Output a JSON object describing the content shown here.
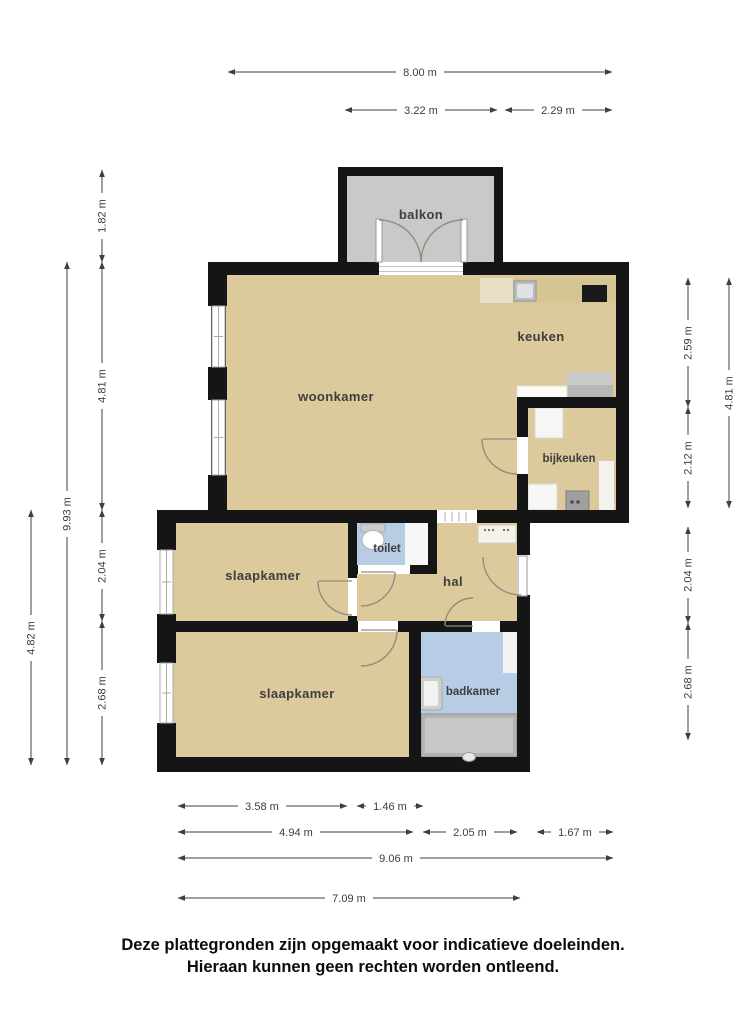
{
  "rooms": {
    "balkon": "balkon",
    "woonkamer": "woonkamer",
    "keuken": "keuken",
    "bijkeuken": "bijkeuken",
    "toilet": "toilet",
    "hal": "hal",
    "slaapkamer_1": "slaapkamer",
    "slaapkamer_2": "slaapkamer",
    "badkamer": "badkamer"
  },
  "dims": {
    "top_full": "8.00 m",
    "top_balkon": "3.22 m",
    "top_right": "2.29 m",
    "left_balkon": "1.82 m",
    "left_woonkamer": "4.81 m",
    "left_slaap1": "2.04 m",
    "left_slaap2": "2.68 m",
    "left_total": "9.93 m",
    "left_lower": "4.82 m",
    "right_keuken": "2.59 m",
    "right_bijkeuken": "2.12 m",
    "right_hal": "2.04 m",
    "right_badkamer": "2.68 m",
    "right_upper": "4.81 m",
    "bottom_slaap2": "3.58 m",
    "bottom_toilet": "1.46 m",
    "bottom_left": "4.94 m",
    "bottom_badkamer": "2.05 m",
    "bottom_right": "1.67 m",
    "bottom_total": "9.06 m",
    "bottom_lower": "7.09 m"
  },
  "footer": {
    "line1": "Deze plattegronden zijn opgemaakt voor indicatieve doeleinden.",
    "line2": "Hieraan kunnen geen rechten worden ontleend."
  },
  "colors": {
    "wall": "#151515",
    "floor": "#dcc99c",
    "balcony_floor": "#c9c9c9",
    "wet_floor": "#b7cde5",
    "counter": "#d7c493",
    "background": "#ffffff"
  }
}
